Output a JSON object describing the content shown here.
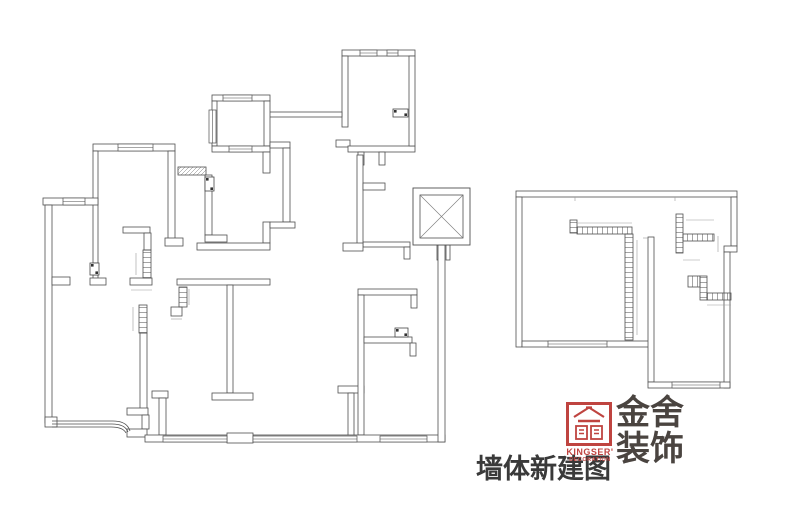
{
  "title": {
    "text": "墙体新建图"
  },
  "logo": {
    "cn_line1": "金舍",
    "cn_line2": "装饰",
    "en": "KINGSER'",
    "en_sub": "DECORATION",
    "red": "#bf4440",
    "dark": "#4a4440"
  },
  "drawing": {
    "wall_stroke": "#4f4f4f",
    "dim_stroke": "#9a9a9a",
    "main_plan": {
      "walls": [
        [
          342,
          50,
          73,
          6
        ],
        [
          342,
          56,
          6,
          71
        ],
        [
          336,
          140,
          14,
          7
        ],
        [
          348,
          146,
          67,
          6
        ],
        [
          409,
          56,
          6,
          90
        ],
        [
          358,
          152,
          6,
          13
        ],
        [
          379,
          152,
          6,
          13
        ],
        [
          268,
          112,
          74,
          5
        ],
        [
          212,
          95,
          58,
          6
        ],
        [
          212,
          101,
          5,
          45
        ],
        [
          264,
          101,
          6,
          45
        ],
        [
          212,
          146,
          58,
          6
        ],
        [
          263,
          152,
          7,
          21
        ],
        [
          270,
          142,
          20,
          6
        ],
        [
          283,
          148,
          7,
          74
        ],
        [
          263,
          222,
          7,
          21
        ],
        [
          270,
          222,
          25,
          6
        ],
        [
          197,
          243,
          73,
          7
        ],
        [
          205,
          175,
          7,
          60
        ],
        [
          205,
          235,
          22,
          7
        ],
        [
          93,
          144,
          82,
          7
        ],
        [
          93,
          151,
          5,
          112
        ],
        [
          93,
          275,
          5,
          8
        ],
        [
          90,
          278,
          16,
          7
        ],
        [
          168,
          151,
          7,
          89
        ],
        [
          165,
          238,
          18,
          8
        ],
        [
          43,
          198,
          55,
          7
        ],
        [
          45,
          205,
          7,
          218
        ],
        [
          52,
          277,
          18,
          8
        ],
        [
          123,
          227,
          27,
          6
        ],
        [
          144,
          233,
          7,
          17
        ],
        [
          130,
          278,
          22,
          7
        ],
        [
          140,
          333,
          7,
          77
        ],
        [
          127,
          408,
          21,
          7
        ],
        [
          142,
          415,
          7,
          14
        ],
        [
          45,
          417,
          12,
          10
        ],
        [
          127,
          429,
          20,
          8
        ],
        [
          177,
          279,
          93,
          6
        ],
        [
          171,
          307,
          11,
          9
        ],
        [
          227,
          285,
          6,
          108
        ],
        [
          212,
          393,
          41,
          7
        ],
        [
          152,
          391,
          16,
          7
        ],
        [
          159,
          398,
          7,
          37
        ],
        [
          338,
          386,
          26,
          7
        ],
        [
          348,
          393,
          6,
          47
        ],
        [
          358,
          289,
          59,
          6
        ],
        [
          411,
          295,
          6,
          13
        ],
        [
          358,
          295,
          6,
          140
        ],
        [
          364,
          337,
          48,
          6
        ],
        [
          410,
          343,
          6,
          13
        ],
        [
          145,
          435,
          300,
          7
        ],
        [
          227,
          433,
          26,
          10
        ],
        [
          363,
          242,
          47,
          5
        ],
        [
          404,
          247,
          6,
          12
        ],
        [
          357,
          155,
          6,
          92
        ],
        [
          343,
          243,
          20,
          8
        ],
        [
          363,
          183,
          22,
          7
        ],
        [
          437,
          245,
          4,
          15
        ],
        [
          446,
          245,
          4,
          15
        ],
        [
          438,
          245,
          7,
          197
        ]
      ],
      "windows": [
        [
          360,
          50,
          17,
          6
        ],
        [
          387,
          50,
          11,
          6
        ],
        [
          223,
          95,
          29,
          6
        ],
        [
          209,
          110,
          7,
          33
        ],
        [
          229,
          146,
          23,
          6
        ],
        [
          118,
          144,
          35,
          7
        ],
        [
          63,
          198,
          22,
          7
        ],
        [
          163,
          436,
          64,
          6
        ],
        [
          253,
          436,
          104,
          6
        ],
        [
          380,
          436,
          47,
          6
        ]
      ],
      "hatch_openings": [
        [
          178,
          167,
          28,
          8
        ]
      ],
      "new_walls": [
        [
          143,
          250,
          8,
          28
        ],
        [
          139,
          305,
          8,
          28
        ],
        [
          179,
          287,
          8,
          20
        ]
      ],
      "fixtures": [
        [
          393,
          109,
          15,
          8
        ],
        [
          205,
          177,
          9,
          14
        ],
        [
          90,
          263,
          9,
          12
        ],
        [
          395,
          328,
          13,
          9
        ]
      ],
      "elevator": {
        "outer": [
          413,
          188,
          57,
          57
        ],
        "inner": [
          420,
          195,
          43,
          43
        ]
      },
      "bay_lines": [
        "M52,421 H113 Q127,421 130,431",
        "M52,424 H112 Q125,424 128,432",
        "M52,427 H111 Q123,427 126,433"
      ],
      "dim_lines": [
        "M136,253 V275",
        "M133,307 V331",
        "M189,289 V305",
        "M131,290 H152",
        "M171,319 H182"
      ]
    },
    "annex_plan": {
      "walls": [
        [
          516,
          191,
          221,
          6
        ],
        [
          731,
          197,
          6,
          49
        ],
        [
          724,
          246,
          13,
          6
        ],
        [
          724,
          252,
          6,
          136
        ],
        [
          516,
          197,
          6,
          150
        ],
        [
          522,
          341,
          130,
          6
        ],
        [
          648,
          237,
          6,
          145
        ],
        [
          648,
          382,
          82,
          6
        ]
      ],
      "windows": [
        [
          548,
          341,
          59,
          6
        ],
        [
          672,
          382,
          48,
          6
        ]
      ],
      "hatch_openings": [],
      "new_walls": [
        [
          570,
          220,
          7,
          13
        ],
        [
          577,
          227,
          55,
          7
        ],
        [
          625,
          234,
          8,
          106
        ],
        [
          676,
          214,
          7,
          39
        ],
        [
          683,
          234,
          31,
          7
        ],
        [
          688,
          276,
          12,
          11
        ],
        [
          700,
          276,
          7,
          24
        ],
        [
          707,
          293,
          24,
          7
        ]
      ],
      "fixtures": [],
      "bay_lines": [],
      "dim_lines": [
        "M575,197 V201",
        "M675,197 V201",
        "M643,238 H648",
        "M577,223 H632",
        "M637,240 V335",
        "M686,220 H714",
        "M718,236 V252",
        "M683,260 H700",
        "M707,305 H731"
      ]
    }
  }
}
